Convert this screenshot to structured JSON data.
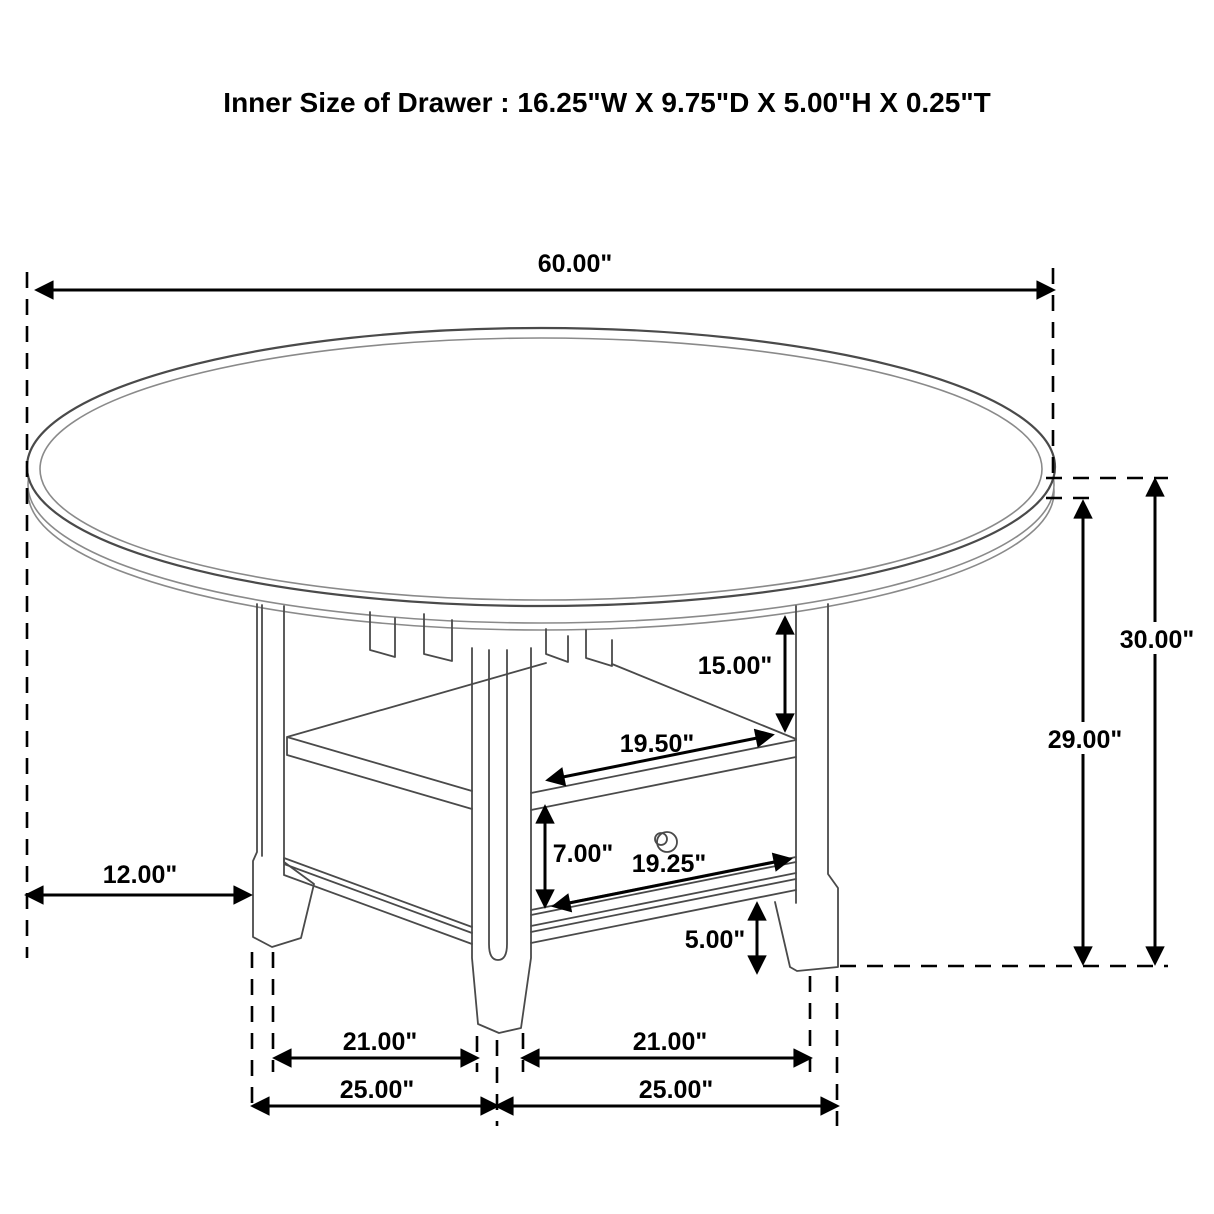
{
  "title": "Inner Size of Drawer : 16.25\"W X 9.75\"D X 5.00\"H X 0.25\"T",
  "dims": {
    "top_diameter": "60.00\"",
    "overall_height": "30.00\"",
    "underside_height": "29.00\"",
    "shelf_opening_height": "15.00\"",
    "drawer_top_width": "19.50\"",
    "drawer_front_height": "7.00\"",
    "drawer_bottom_width": "19.25\"",
    "rail_floor_clearance": "5.00\"",
    "top_overhang": "12.00\"",
    "inner_leg_span_left": "21.00\"",
    "inner_leg_span_right": "21.00\"",
    "outer_leg_span_left": "25.00\"",
    "outer_leg_span_right": "25.00\""
  },
  "colors": {
    "dimension_line": "#000000",
    "furniture_line": "#4a4a4a",
    "background": "#ffffff"
  }
}
